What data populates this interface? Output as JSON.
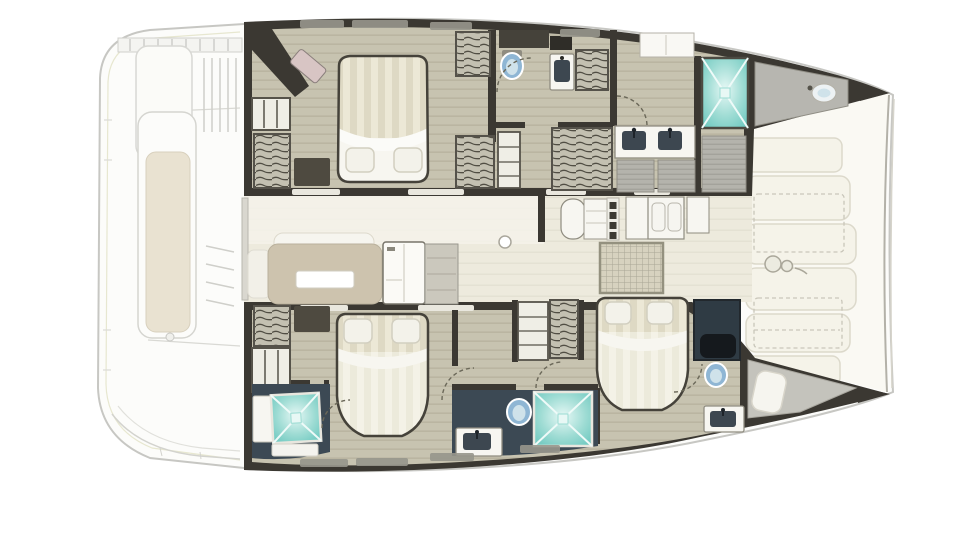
{
  "meta": {
    "title": "Catamaran yacht floor plan - top view",
    "figure_type": "floor-plan",
    "visible_text": []
  },
  "palette": {
    "pageBg": "#ffffff",
    "hullFill": "#fcfcfa",
    "hullStroke": "#c7c7c3",
    "wallDark": "#3b3832",
    "woodBase": "#c7c3b0",
    "woodLine": "#bab5a1",
    "salonBase": "#edeadd",
    "salonLight": "#f4f2ea",
    "deckPad": "#f5f3e9",
    "deckPadStroke": "#dcd9cb",
    "foredeckBase": "#faf9f3",
    "hatchBg": "#c3c0b1",
    "hatchLine": "#514e44",
    "navyFloor": "#3c4954",
    "grayPanel": "#b4b3ac",
    "grayPanelLine": "#a3a29b",
    "mattressA": "#ded9c4",
    "mattressB": "#ece8d6",
    "duvetA": "#eceadb",
    "duvetB": "#f4f2e7",
    "sheetWhite": "#f7f6f0",
    "pillow": "#f3f2ea",
    "pillowStroke": "#d2cfc0",
    "bedOutline": "#45423a",
    "sofaBeige": "#cdc3ae",
    "sofaBack": "#f6f5ef",
    "tableWhite": "#ffffff",
    "deskBrown": "#4e4a40",
    "pinkSeat": "#d8c5c4",
    "windowGray": "#97968c",
    "windowCream": "#e9e7de",
    "unitWhite": "#f7f6f1",
    "unitStroke": "#8f8c80",
    "basinDark": "#3d4750",
    "toiletBlue": "#8fb6d4",
    "glassBlue": "#cfe2ea",
    "dashLine": "#6b6859",
    "gridBase": "#d7d2bf",
    "gridLine": "#aaa695",
    "benchCushion": "#e9e2d1",
    "showerTealA": "#74cdc4",
    "showerTealB": "#e6f8f5",
    "showerLine": "#eefaf8"
  },
  "inventory": {
    "aft_deck": [
      "swim-steps",
      "cockpit-bench-with-cushion",
      "deck-louvers",
      "transom-platform"
    ],
    "port_hull": {
      "aft_cabin": [
        "double-berth",
        "two-pillows",
        "hanging-wardrobes",
        "shelf-unit",
        "vanity-desk",
        "corner-seat"
      ],
      "aft_head": [
        "toilet",
        "washbasin-unit",
        "hanging-locker",
        "counter"
      ],
      "forward_head": [
        "double-washbasin-vanity",
        "shower-cabin",
        "gray-floor-panels"
      ],
      "bow": [
        "counter-with-round-sink"
      ]
    },
    "bridge_deck": [
      "sliding-door",
      "dinette-sofa",
      "sofa-backrest",
      "dinette-table",
      "fridge-cabinet",
      "counter-unit",
      "galley-island-with-burners",
      "double-sink-unit",
      "worktops",
      "floor-hatch-grid",
      "compression-post"
    ],
    "starboard_hull": {
      "aft_cabin": [
        "double-berth",
        "two-pillows",
        "hanging-wardrobe",
        "shelf-unit",
        "vanity-desk",
        "shower-cabin",
        "washbasin-unit"
      ],
      "mid_head": [
        "washbasin-unit",
        "toilet",
        "shower-cabin"
      ],
      "forward_cabin": [
        "double-berth",
        "two-pillows",
        "wardrobe",
        "shelf-unit",
        "dark-closet-with-bench",
        "toilet",
        "washbasin-unit"
      ],
      "bow": [
        "seat-pad"
      ]
    },
    "foredeck": [
      "sun-pad-panels",
      "dashed-locker-outlines",
      "windlass-winch",
      "storage-cabinets",
      "bow-edge-lines"
    ]
  }
}
